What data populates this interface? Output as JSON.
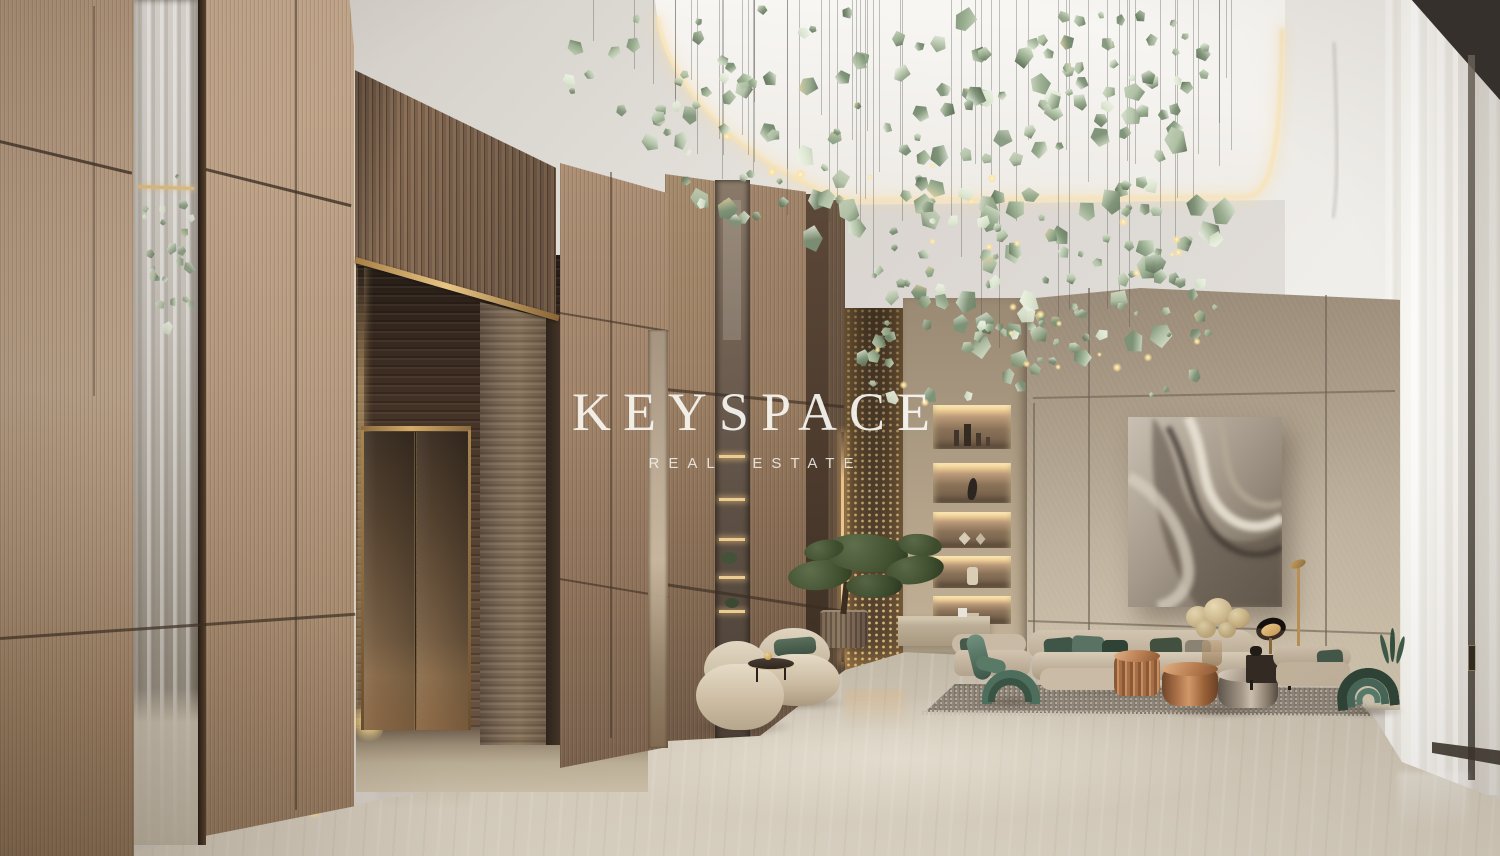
{
  "watermark": {
    "brand": "KEYSPACE",
    "tagline": "REAL ESTATE"
  },
  "scene": {
    "setting": "luxury residential lobby interior rendering",
    "elements": [
      "wood panel walls",
      "mirror inlay strips",
      "fluted wood transom",
      "brass trim",
      "bronze elevator doors",
      "travertine portal",
      "green crystal chandelier",
      "backlit display niches",
      "perforated bronze screen",
      "bonsai tree",
      "boucle armchairs",
      "sectional sofa",
      "green sculptural chairs",
      "copper coffee tables",
      "abstract metal artwork",
      "stone feature wall",
      "travertine floor",
      "area rug",
      "sheer curtains",
      "floor uplights"
    ]
  },
  "palette": {
    "wood": "#b99c82",
    "wood_dark": "#8a715d",
    "slat_wood": "#7c6350",
    "stone_wall": "#b3a492",
    "floor": "#d2c9b9",
    "ceiling": "#e7e4df",
    "cove_glow": "#f6ddab",
    "brass": "#c9a25e",
    "bronze_door": "#6e573f",
    "crystal_green": "#afc0a4",
    "pillow_green": "#44584a",
    "copper": "#b07a52",
    "curtain_white": "#f7f5f0",
    "rug": "#8f8679",
    "artwork_metal": "#a59a8b"
  },
  "chandelier": {
    "palette": [
      "#f1f5e9",
      "#dee8d3",
      "#c7d3bb",
      "#afc0a4",
      "#95aa8b",
      "#7d9276",
      "#687d63",
      "#53644d"
    ],
    "warm_accent": "#e7d6a4",
    "glow_color": "#ffe9b0",
    "wire_color": "rgba(70,70,64,0.32)",
    "clusters": [
      {
        "cx": 850,
        "cy": 112,
        "rx": 240,
        "ry": 120,
        "n": 80,
        "smin": 7,
        "smax": 21
      },
      {
        "cx": 1045,
        "cy": 210,
        "rx": 170,
        "ry": 145,
        "n": 85,
        "smin": 7,
        "smax": 23
      },
      {
        "cx": 965,
        "cy": 325,
        "rx": 125,
        "ry": 90,
        "n": 40,
        "smin": 6,
        "smax": 15
      },
      {
        "cx": 1140,
        "cy": 300,
        "rx": 80,
        "ry": 100,
        "n": 26,
        "smin": 5,
        "smax": 13
      },
      {
        "cx": 650,
        "cy": 60,
        "rx": 92,
        "ry": 58,
        "n": 18,
        "smin": 6,
        "smax": 15
      },
      {
        "cx": 1120,
        "cy": 55,
        "rx": 100,
        "ry": 58,
        "n": 30,
        "smin": 6,
        "smax": 16
      }
    ],
    "mirror_cluster": {
      "cx": 31,
      "cy": 248,
      "rx": 30,
      "ry": 82,
      "n": 22,
      "smin": 4,
      "smax": 11
    },
    "lights": 28,
    "wires": 56,
    "envelope": [
      [
        595,
        95
      ],
      [
        700,
        185
      ],
      [
        850,
        285
      ],
      [
        950,
        365
      ],
      [
        1080,
        390
      ],
      [
        1170,
        330
      ],
      [
        1245,
        180
      ]
    ]
  },
  "niches": {
    "objects": [
      "bottles",
      "sculpture",
      "faceted stones",
      "vase",
      "bowl"
    ]
  }
}
